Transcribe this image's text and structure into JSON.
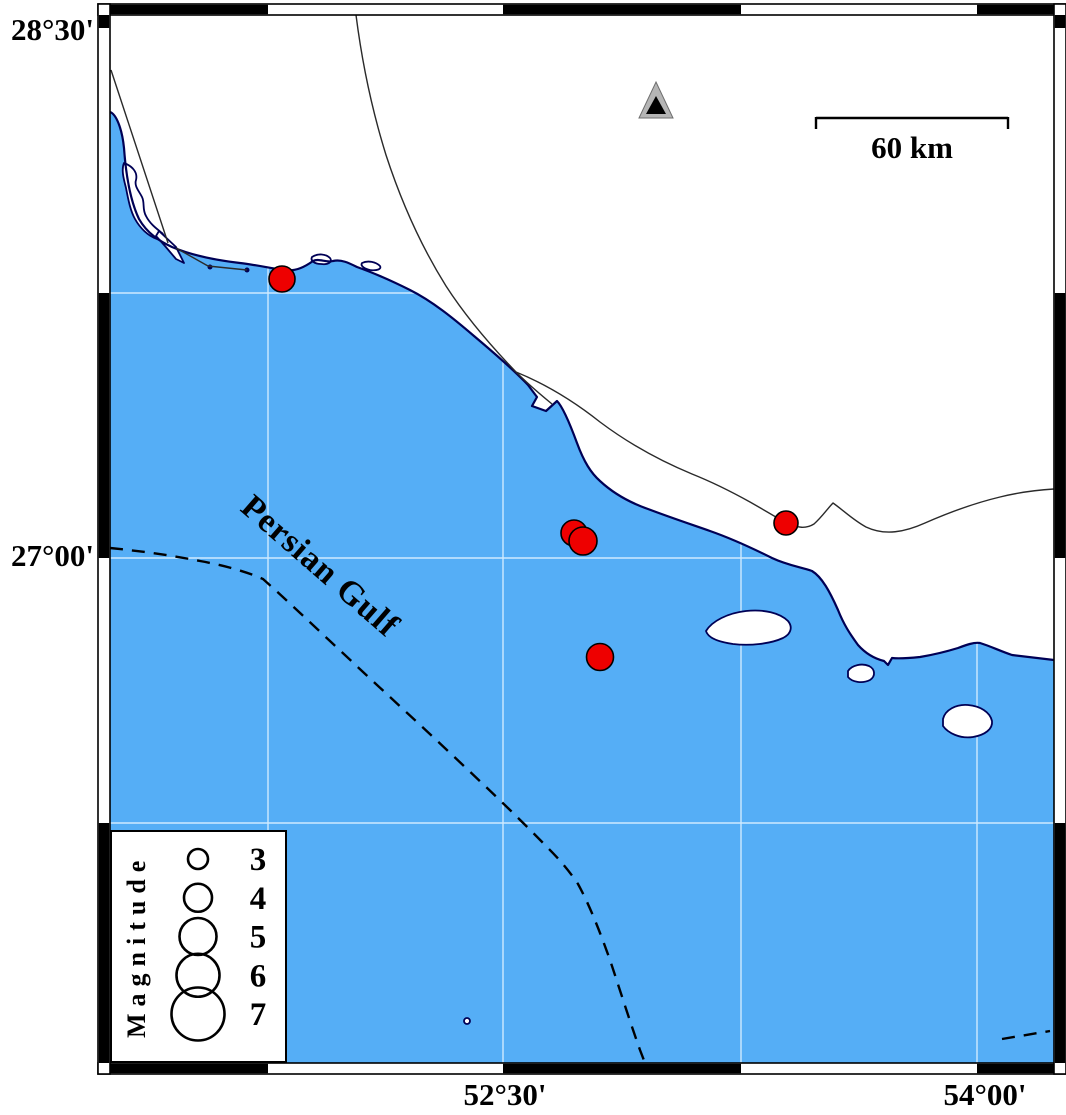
{
  "figure": {
    "type": "seismicity-map",
    "region_label": "Persian Gulf",
    "frame": {
      "top_left_latitude": "28°30'",
      "left_latitude": "27°00'",
      "bottom_longitudes": [
        "52°30'",
        "54°00'"
      ]
    },
    "scale_bar": {
      "label": "60 km"
    },
    "station": {
      "symbol": "triangle",
      "x": 656,
      "y": 104
    },
    "earthquakes": [
      {
        "x": 282,
        "y": 279,
        "r": 13
      },
      {
        "x": 574,
        "y": 533,
        "r": 13
      },
      {
        "x": 583,
        "y": 541,
        "r": 14
      },
      {
        "x": 600,
        "y": 657,
        "r": 13.5
      },
      {
        "x": 786,
        "y": 523,
        "r": 12
      }
    ],
    "legend": {
      "title": "Magnitude",
      "entries": [
        {
          "label": "3",
          "r": 10
        },
        {
          "label": "4",
          "r": 14
        },
        {
          "label": "5",
          "r": 18.5
        },
        {
          "label": "6",
          "r": 21.5
        },
        {
          "label": "7",
          "r": 26.5
        }
      ]
    },
    "colors": {
      "sea": "#55AEF6",
      "land": "#FFFFFF",
      "coastline": "#000055",
      "epicenter": "#EE0000",
      "gridline": "#CFEAFF",
      "station_gray": "#B5B5B5"
    }
  }
}
